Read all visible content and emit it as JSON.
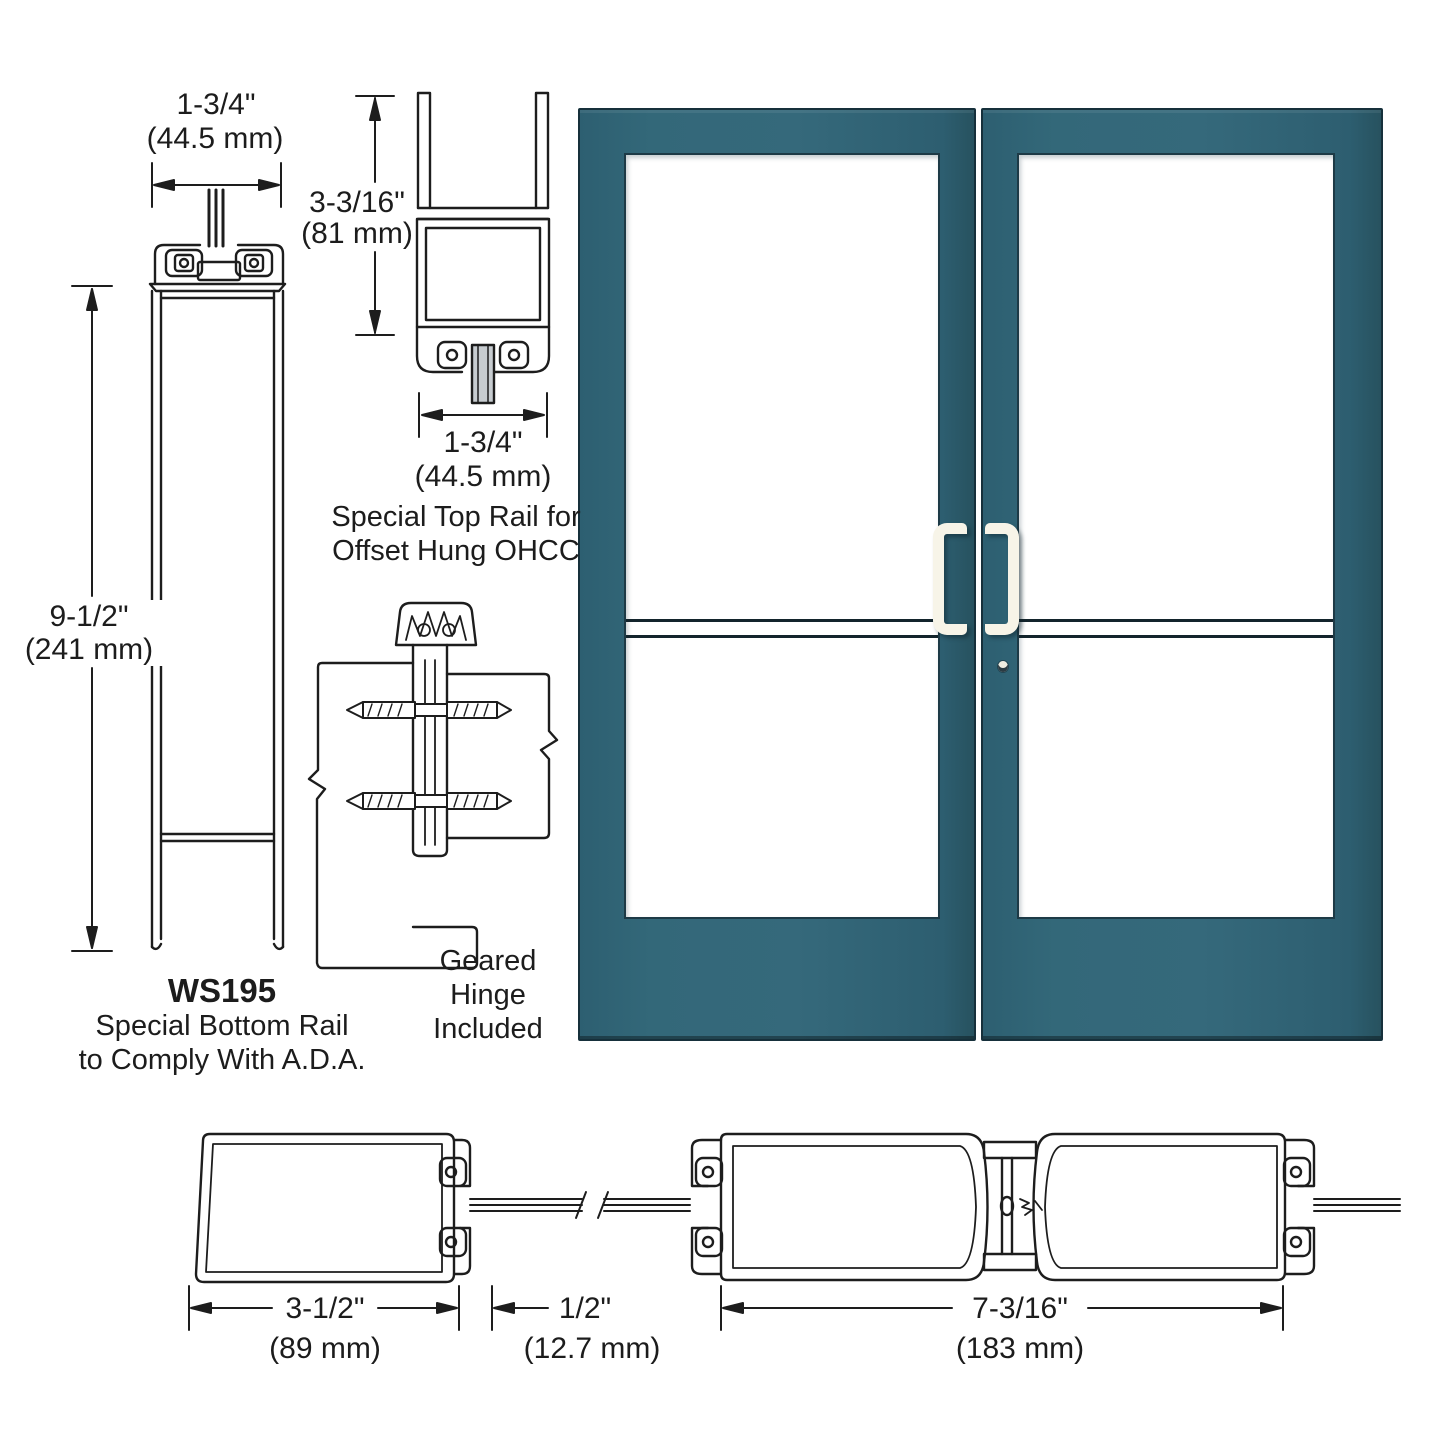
{
  "colors": {
    "door_teal": "#336879",
    "handle_cream": "#f7f4e8",
    "line_art": "#1d1d1d",
    "glass_white": "#ffffff"
  },
  "bottom_rail_detail": {
    "width_dim_in": "1-3/4\"",
    "width_dim_mm": "(44.5 mm)",
    "height_dim_in": "9-1/2\"",
    "height_dim_mm": "(241 mm)",
    "model": "WS195",
    "caption_line1": "Special Bottom Rail",
    "caption_line2": "to Comply With A.D.A."
  },
  "top_rail_detail": {
    "height_dim_in": "3-3/16\"",
    "height_dim_mm": "(81 mm)",
    "width_dim_in": "1-3/4\"",
    "width_dim_mm": "(44.5 mm)",
    "caption_line1": "Special Top Rail for",
    "caption_line2": "Offset Hung OHCC"
  },
  "hinge_detail": {
    "caption_line1": "Geared",
    "caption_line2": "Hinge",
    "caption_line3": "Included"
  },
  "stile_details": {
    "stile_width_in": "3-1/2\"",
    "stile_width_mm": "(89 mm)",
    "glass_stop_in": "1/2\"",
    "glass_stop_mm": "(12.7 mm)",
    "pair_width_in": "7-3/16\"",
    "pair_width_mm": "(183 mm)"
  }
}
